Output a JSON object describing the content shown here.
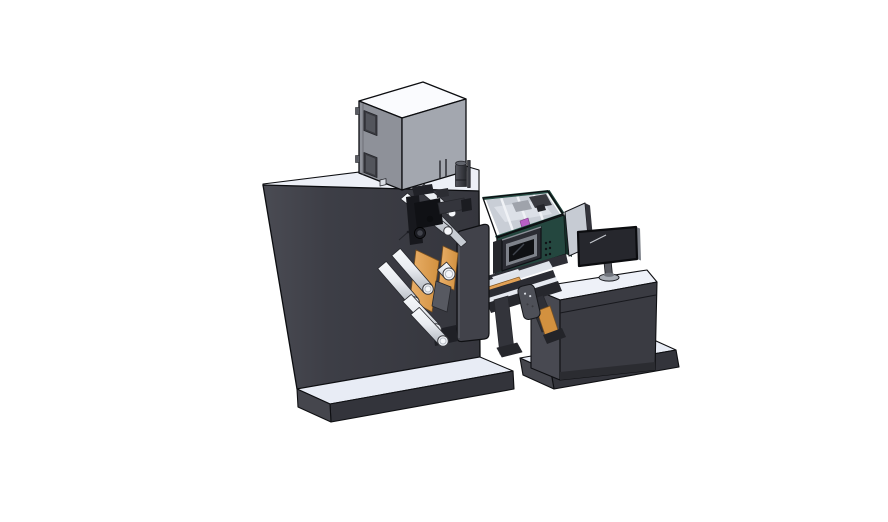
{
  "scene": {
    "type": "3d-cad-render",
    "description": "Isometric CAD rendering of a roll-fed label printing and converting machine: large dark cabinet with web rollers and orange ribbon path, fume-extractor box on top, teal process unit with HMI display, output conveyor with product sensor, and an operator desk with a monitor, all standing on flat base plates against a white background",
    "background": "#ffffff",
    "view": "isometric"
  },
  "palette": {
    "outline": "#101014",
    "machine_body_dark": "#3b3c43",
    "machine_body_light": "#4a4b53",
    "top_surface_white": "#edf0f7",
    "extractor_front": "#a3a7af",
    "extractor_side": "#8e9199",
    "extractor_top": "#fafbfe",
    "teal_unit_front": "#24473f",
    "teal_rim": "#2e5b50",
    "interior_gray": "#c9ced6",
    "web_orange": "#e2a155",
    "chute_orange": "#d3913f",
    "roller_white": "#f5f7fa",
    "magenta_part": "#b95fc4",
    "display_bezel": "#2b2c33",
    "screen_black": "#0f1013",
    "monitor_dark": "#26272d",
    "deflector_gray": "#c6cbd3",
    "desk_front": "#3a3b42",
    "slab_top": "#e8ecf5",
    "slab_front": "#33343b"
  },
  "components": [
    {
      "name": "main-cabinet",
      "description": "large dark machine cabinet with white top"
    },
    {
      "name": "base-plate-left",
      "description": "flat floor plate under the machine"
    },
    {
      "name": "fume-extractor-box",
      "description": "gray box with viewing windows and vents sitting on the cabinet top"
    },
    {
      "name": "extractor-knob",
      "description": "dark cylindrical cap beside the extractor box"
    },
    {
      "name": "print-head-mechanism",
      "description": "black printing/marking head assembly"
    },
    {
      "name": "web-rollers",
      "description": "white guide rollers for the material web"
    },
    {
      "name": "web-ribbon",
      "description": "orange material web wrapped over the rollers"
    },
    {
      "name": "roller-door-plate",
      "description": "rounded vertical cover plate"
    },
    {
      "name": "process-unit",
      "description": "open-top teal unit with internal dividers and magenta part"
    },
    {
      "name": "hmi-display",
      "description": "small operator display on the teal unit"
    },
    {
      "name": "output-conveyor",
      "description": "angled discharge conveyor with orange belt"
    },
    {
      "name": "product-sensor",
      "description": "dark rounded sensor on the conveyor"
    },
    {
      "name": "deflector-panel",
      "description": "light gray guide panel behind the monitor"
    },
    {
      "name": "operator-desk",
      "description": "dark cabinet desk with white top"
    },
    {
      "name": "base-plate-right",
      "description": "flat floor plate under the desk"
    },
    {
      "name": "monitor",
      "description": "flat screen monitor on a round stand"
    }
  ]
}
